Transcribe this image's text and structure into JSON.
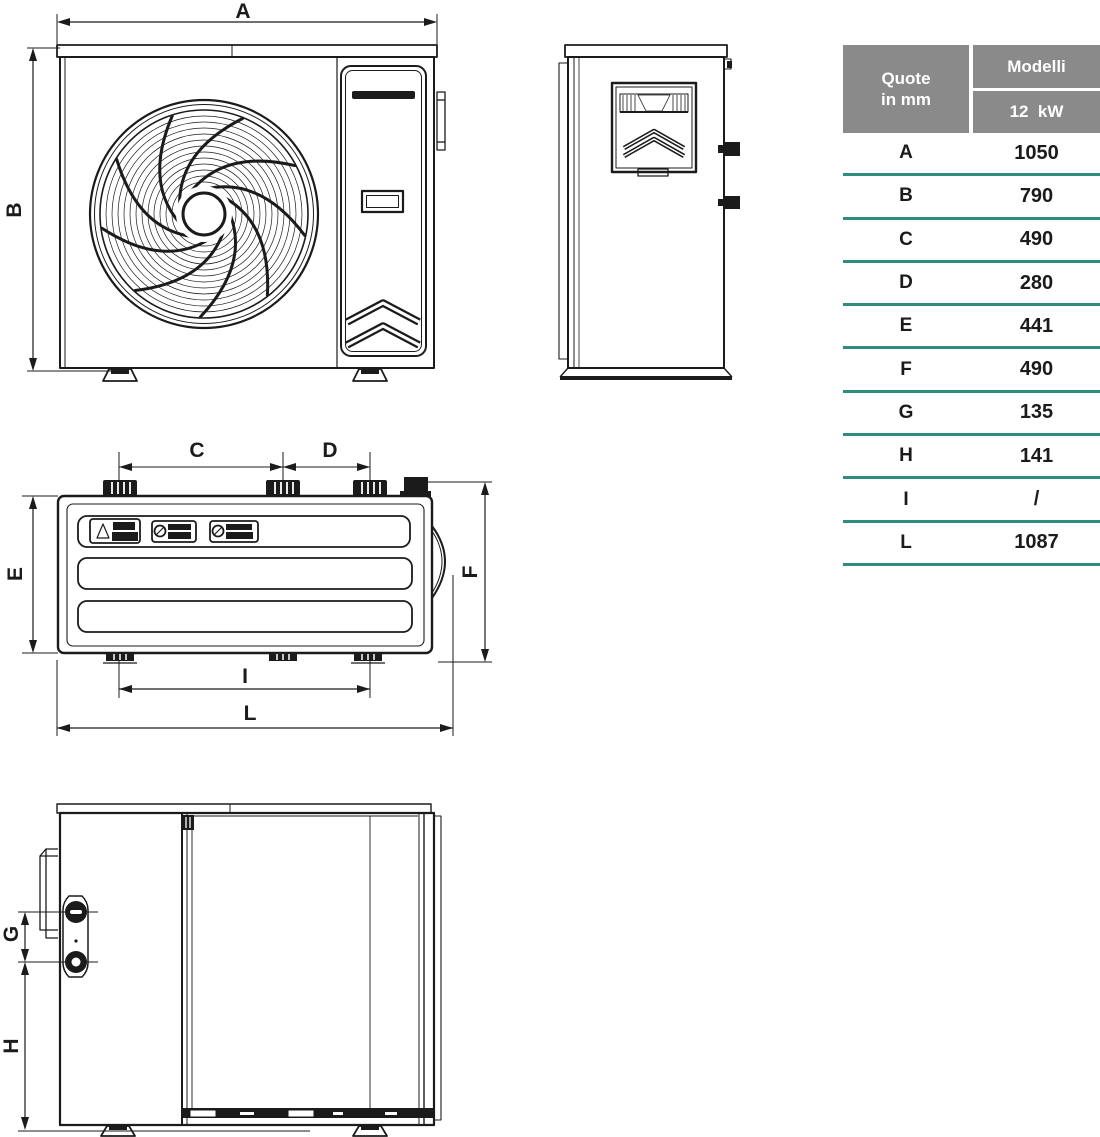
{
  "colors": {
    "header-bg": "#8a8a8a",
    "separator": "#2e8b7e",
    "ink": "#1b1b1b"
  },
  "dim_labels": {
    "A": "A",
    "B": "B",
    "C": "C",
    "D": "D",
    "E": "E",
    "F": "F",
    "G": "G",
    "H": "H",
    "I": "I",
    "L": "L"
  },
  "table": {
    "quote_line1": "Quote",
    "quote_line2": "in mm",
    "models_header": "Modelli",
    "model_label": "12  kW",
    "rows": [
      {
        "label": "A",
        "value": "1050"
      },
      {
        "label": "B",
        "value": "790"
      },
      {
        "label": "C",
        "value": "490"
      },
      {
        "label": "D",
        "value": "280"
      },
      {
        "label": "E",
        "value": "441"
      },
      {
        "label": "F",
        "value": "490"
      },
      {
        "label": "G",
        "value": "135"
      },
      {
        "label": "H",
        "value": "141"
      },
      {
        "label": "I",
        "value": "/"
      },
      {
        "label": "L",
        "value": "1087"
      }
    ]
  }
}
